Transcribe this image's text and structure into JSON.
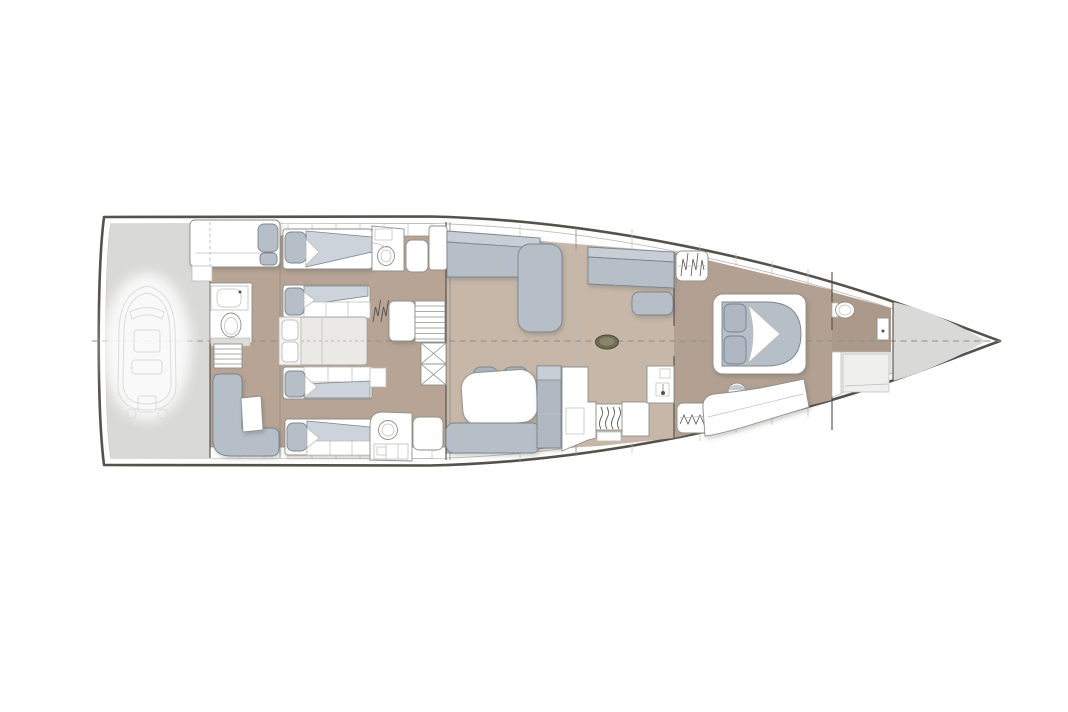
{
  "meta": {
    "title": "Sailing yacht interior deck plan, bow to the right",
    "type": "floor-plan",
    "orientation": "bow-right"
  },
  "colors": {
    "line-dark": "#55524c",
    "line-mid": "#8f8e89",
    "line-light": "#bdbcb8",
    "locker-gray": "#d9d9d7",
    "floor-aft": "#b7a495",
    "floor-salon": "#c6b7a9",
    "floor-fwd": "#b2a092",
    "floor-fwdhead": "#ab9a8b",
    "upholstery": "#b6bec8",
    "upholstery-dark": "#c7ced5",
    "cushion-light": "#ccd3da",
    "uph-line": "#7d848d",
    "mattress-light": "#ebe9e5",
    "mast-olive": "#6f6b58",
    "mast-olive-inner": "#8a8568",
    "ghost-line": "#dcdcda",
    "shower-light": "#efefed"
  },
  "rooms": [
    {
      "id": "tender-garage",
      "contains": [
        "dinghy"
      ]
    },
    {
      "id": "aft-port-cabin",
      "berths": 2
    },
    {
      "id": "aft-port-head",
      "fixtures": [
        "toilet",
        "sink"
      ]
    },
    {
      "id": "center-double-berth",
      "berths": 1
    },
    {
      "id": "aft-starboard-cabin",
      "berths": 2
    },
    {
      "id": "aft-starboard-head",
      "fixtures": [
        "sink",
        "counter"
      ]
    },
    {
      "id": "aft-starboard-lounge",
      "contains": [
        "l-sofa",
        "table"
      ]
    },
    {
      "id": "salon",
      "contains": [
        "l-sofa",
        "sofa",
        "ottoman",
        "mast-base",
        "dining-table",
        "chairs",
        "bench"
      ]
    },
    {
      "id": "galley",
      "contains": [
        "stove",
        "sink",
        "counters"
      ]
    },
    {
      "id": "forward-owner-cabin",
      "contains": [
        "double-bed",
        "stool",
        "lounge-pad",
        "hanging-lockers"
      ]
    },
    {
      "id": "forward-head",
      "fixtures": [
        "toilet",
        "shower"
      ]
    },
    {
      "id": "bow-sail-locker",
      "contains": []
    }
  ]
}
